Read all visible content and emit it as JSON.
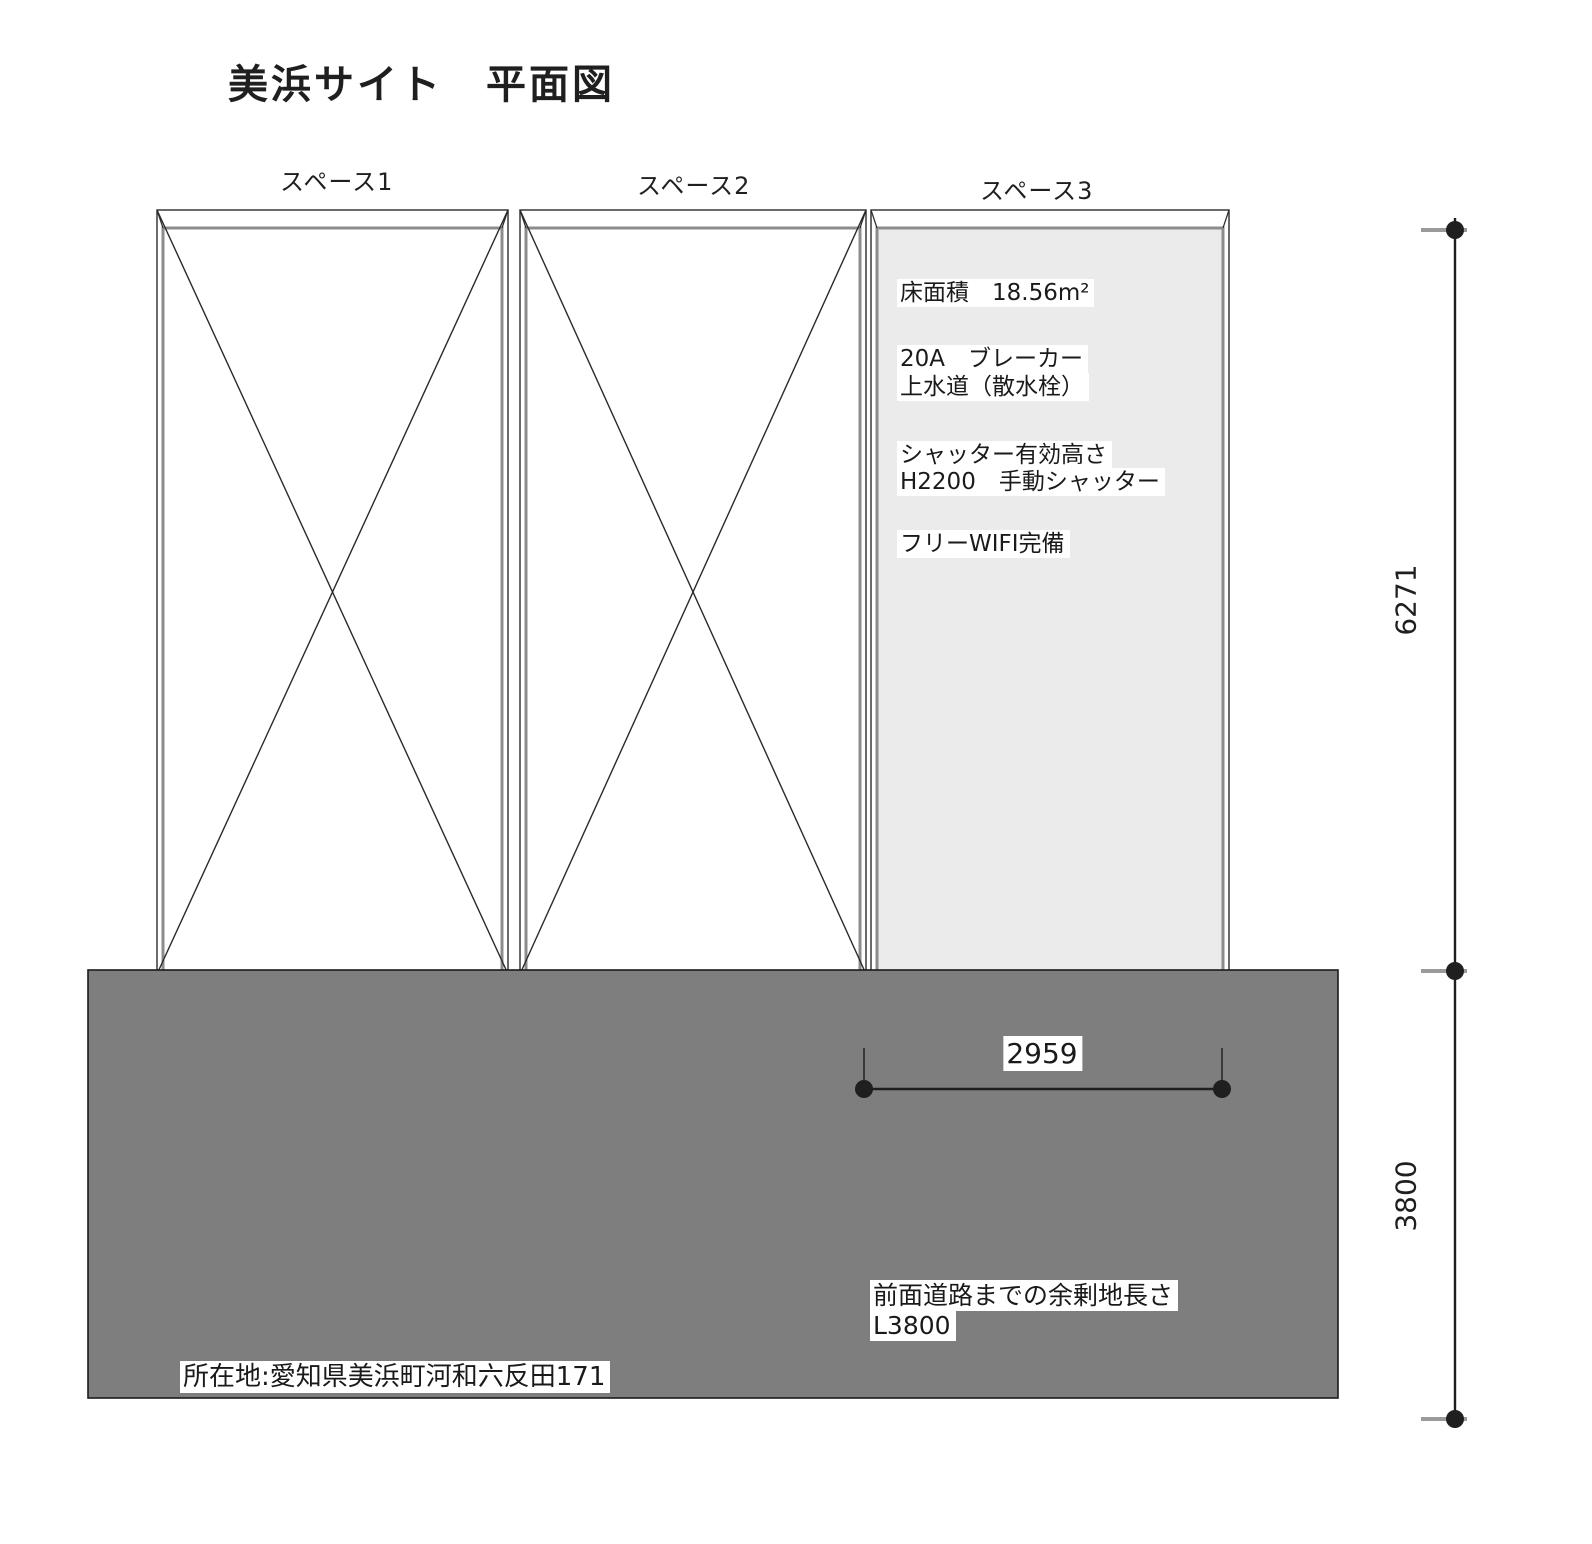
{
  "title": "美浜サイト　平面図",
  "spaces": [
    {
      "label": "スペース1",
      "has_x_mark": true
    },
    {
      "label": "スペース2",
      "has_x_mark": true
    },
    {
      "label": "スペース3",
      "has_x_mark": false
    }
  ],
  "space3_notes": {
    "floor_area": "床面積　18.56m²",
    "breaker": "20A　ブレーカー",
    "water_supply": "上水道（散水栓）",
    "shutter_height_label": "シャッター有効高さ",
    "shutter_detail": "H2200　手動シャッター",
    "wifi": "フリーWIFI完備"
  },
  "dimensions": {
    "vertical_upper": "6271",
    "vertical_lower": "3800",
    "horizontal_space3": "2959"
  },
  "road_note": {
    "line1": "前面道路までの余剰地長さ",
    "line2": "L3800"
  },
  "address": "所在地:愛知県美浜町河和六反田171",
  "colors": {
    "space3_fill": "#ebebeb",
    "dark_area_fill": "#7e7e7e",
    "outer_line": "#2a2a2a",
    "inner_line": "#8c8c8c",
    "dim_dot": "#1f1f1f",
    "dim_tick": "#9a9a9a"
  }
}
